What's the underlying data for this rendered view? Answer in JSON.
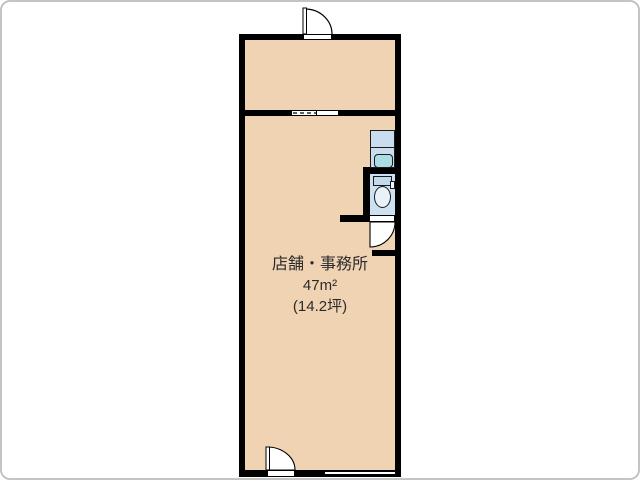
{
  "floorplan": {
    "title": "店舗・事務所 間取り図",
    "room": {
      "label": "店舗・事務所",
      "area_sqm": "47m²",
      "area_tsubo": "(14.2坪)"
    },
    "fixtures": {
      "top_door": "hinged-door",
      "entrance_door": "hinged-door",
      "toilet_door": "hinged-door",
      "divider_door": "sliding-door",
      "window": "double-line-window",
      "sink": "wash-basin-vanity",
      "toilet": "toilet"
    },
    "colors": {
      "room_fill": "#f0d3b3",
      "wall": "#000000",
      "fixture_fill": "#c9ddee",
      "sink_bowl": "#addde4",
      "toilet_room_fill": "#cce2f2",
      "tank_fill": "#c2d8ec",
      "bowl_fill": "#e9f1f9",
      "frame": "#c4c4c4"
    }
  }
}
